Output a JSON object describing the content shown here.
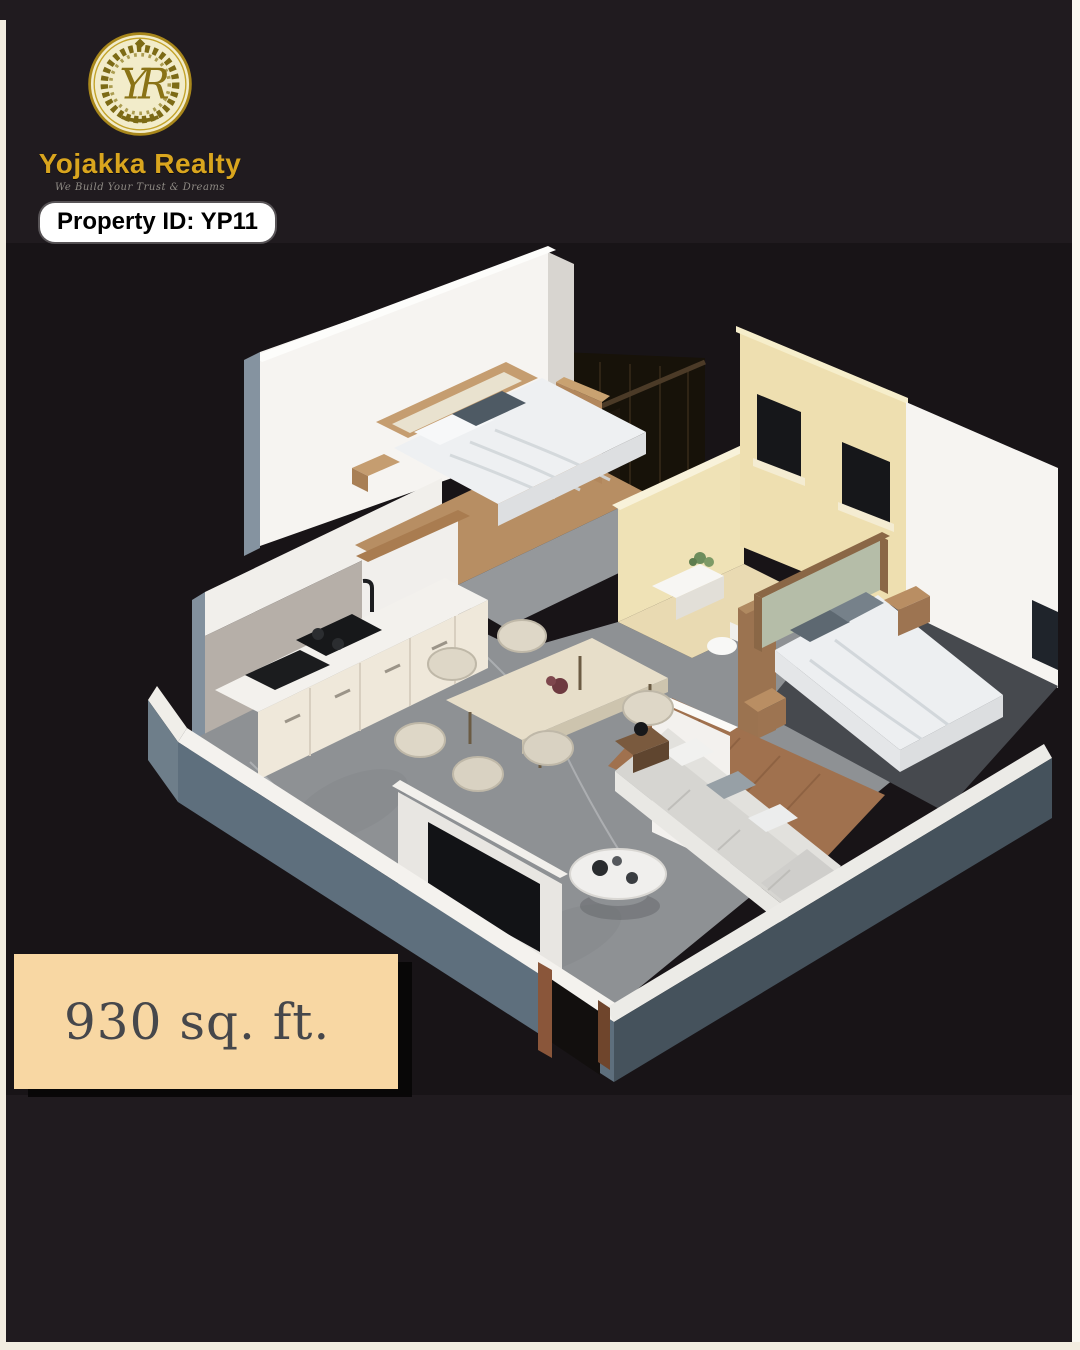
{
  "canvas": {
    "background": "#201b1f",
    "photo_background": "#181417",
    "page_edge_color": "#f2ede0"
  },
  "brand": {
    "name": "Yojakka Realty",
    "tagline": "We Build Your Trust & Dreams",
    "monogram": "YR",
    "name_color": "#d9a51e",
    "emblem_disc_color": "#f2ecca",
    "emblem_ring_color": "#a8871b",
    "emblem_wreath_color": "#7c6a15"
  },
  "property_badge": {
    "text": "Property ID: YP11",
    "background": "#ffffff",
    "text_color": "#000000"
  },
  "area_box": {
    "text": "930 sq. ft.",
    "background": "#f8d7a3",
    "text_color": "#46474b"
  },
  "floor_plan": {
    "type": "3d-isometric-apartment-render",
    "palette": {
      "wall_white": "#f6f4f1",
      "wall_outer_blue_grey": "#5e6f7d",
      "wall_cream": "#eedfb0",
      "backsplash_grey": "#b6afa8",
      "floor_marble": "#8e9194",
      "floor_wood": "#a0714e",
      "furniture_wood": "#b98e63",
      "linen_white": "#eef0f2",
      "sofa_grey": "#d6d5d1",
      "headboard_green": "#b5bda8",
      "window_dark": "#16171a"
    }
  }
}
